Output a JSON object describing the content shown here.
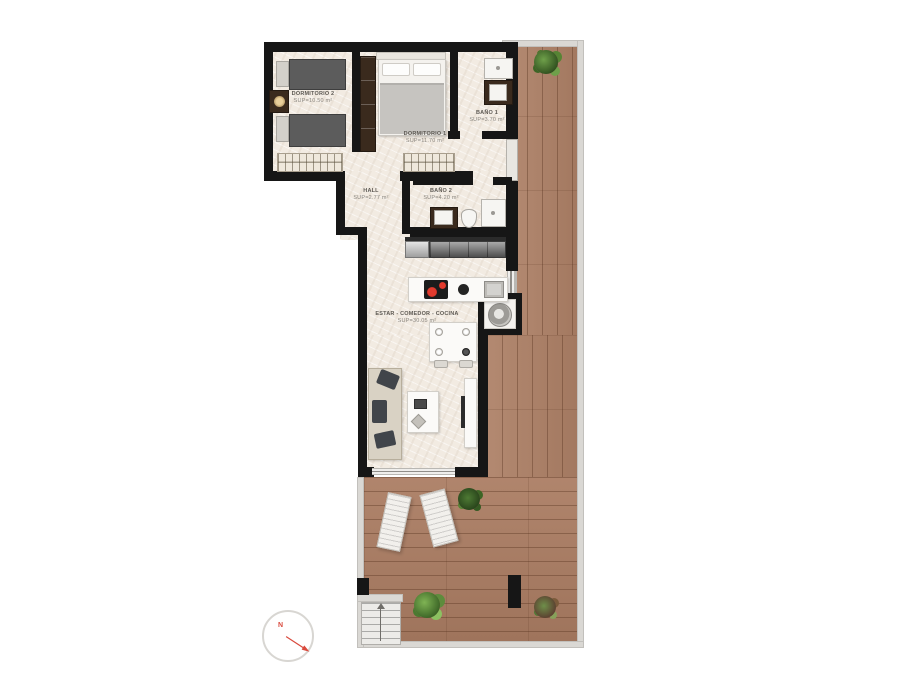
{
  "rooms": [
    {
      "name": "DORMITORIO 2",
      "area": "SUP=10.50 m²"
    },
    {
      "name": "DORMITORIO 1",
      "area": "SUP=11.70 m²"
    },
    {
      "name": "BAÑO 1",
      "area": "SUP=3.70 m²"
    },
    {
      "name": "HALL",
      "area": "SUP=2.77 m²"
    },
    {
      "name": "BAÑO 2",
      "area": "SUP=4.20 m²"
    },
    {
      "name": "ESTAR - COMEDOR - COCINA",
      "area": "SUP=30.05 m²"
    }
  ],
  "compass": {
    "north_label": "N"
  },
  "colors": {
    "wall": "#161616",
    "wood": "#ad8066",
    "interior_floor": "#f2ebe2",
    "terrace_border": "#dad8d4",
    "accent_red": "#d94a3d",
    "plant_green": "#4e7a34"
  }
}
